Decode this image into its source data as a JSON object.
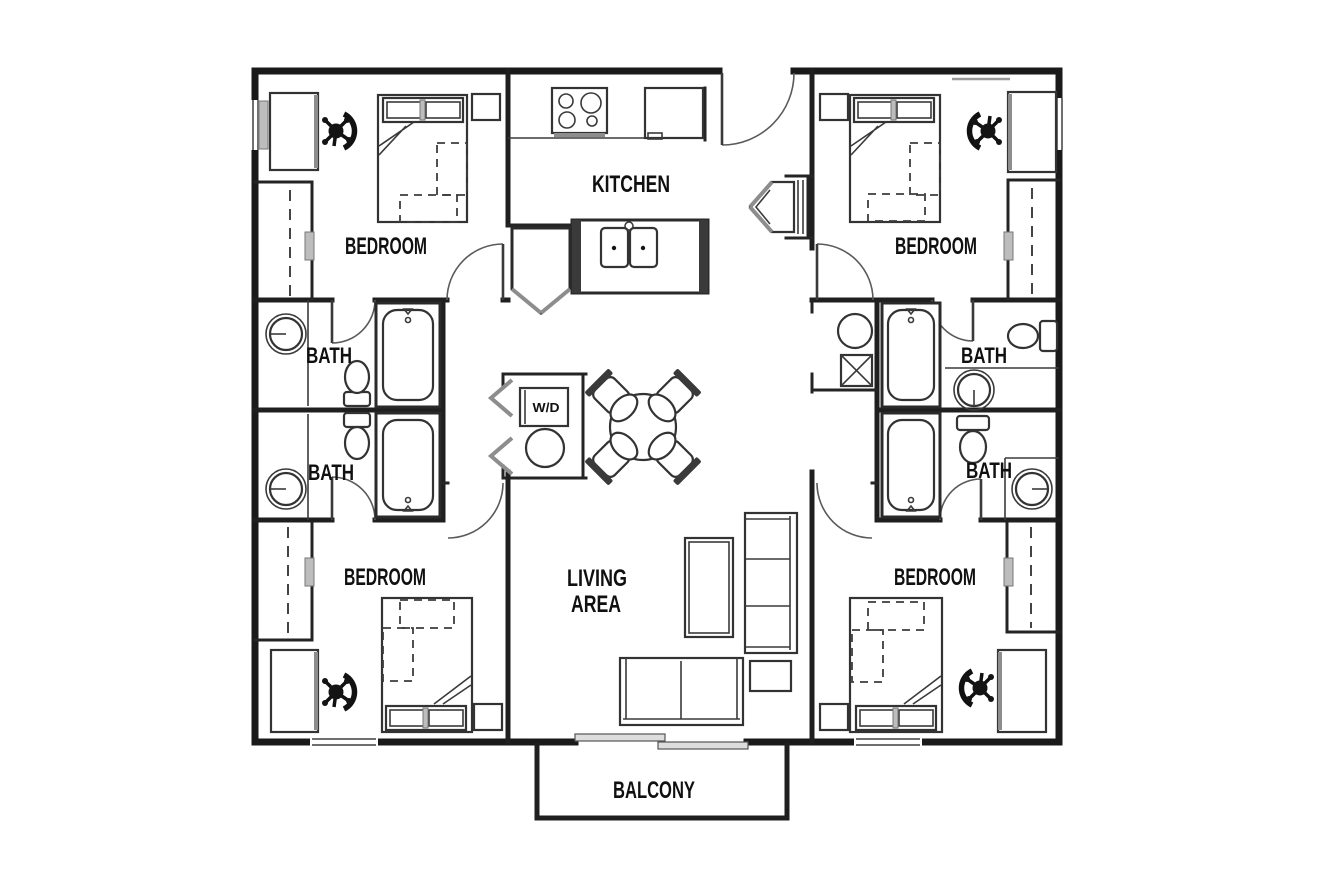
{
  "labels": {
    "bedroom_top_left": "BEDROOM",
    "bedroom_top_right": "BEDROOM",
    "bedroom_bottom_left": "BEDROOM",
    "bedroom_bottom_right": "BEDROOM",
    "kitchen": "KITCHEN",
    "bath_left_upper": "BATH",
    "bath_left_lower": "BATH",
    "bath_right_upper": "BATH",
    "bath_right_lower": "BATH",
    "living_area_line1": "LIVING",
    "living_area_line2": "AREA",
    "washer_dryer": "W/D",
    "balcony": "BALCONY"
  },
  "colors": {
    "background": "#ffffff",
    "walls": "#1a1a1a",
    "furniture_lines": "#333333",
    "window_gray": "#bdbdbd",
    "label_text": "#101010"
  }
}
